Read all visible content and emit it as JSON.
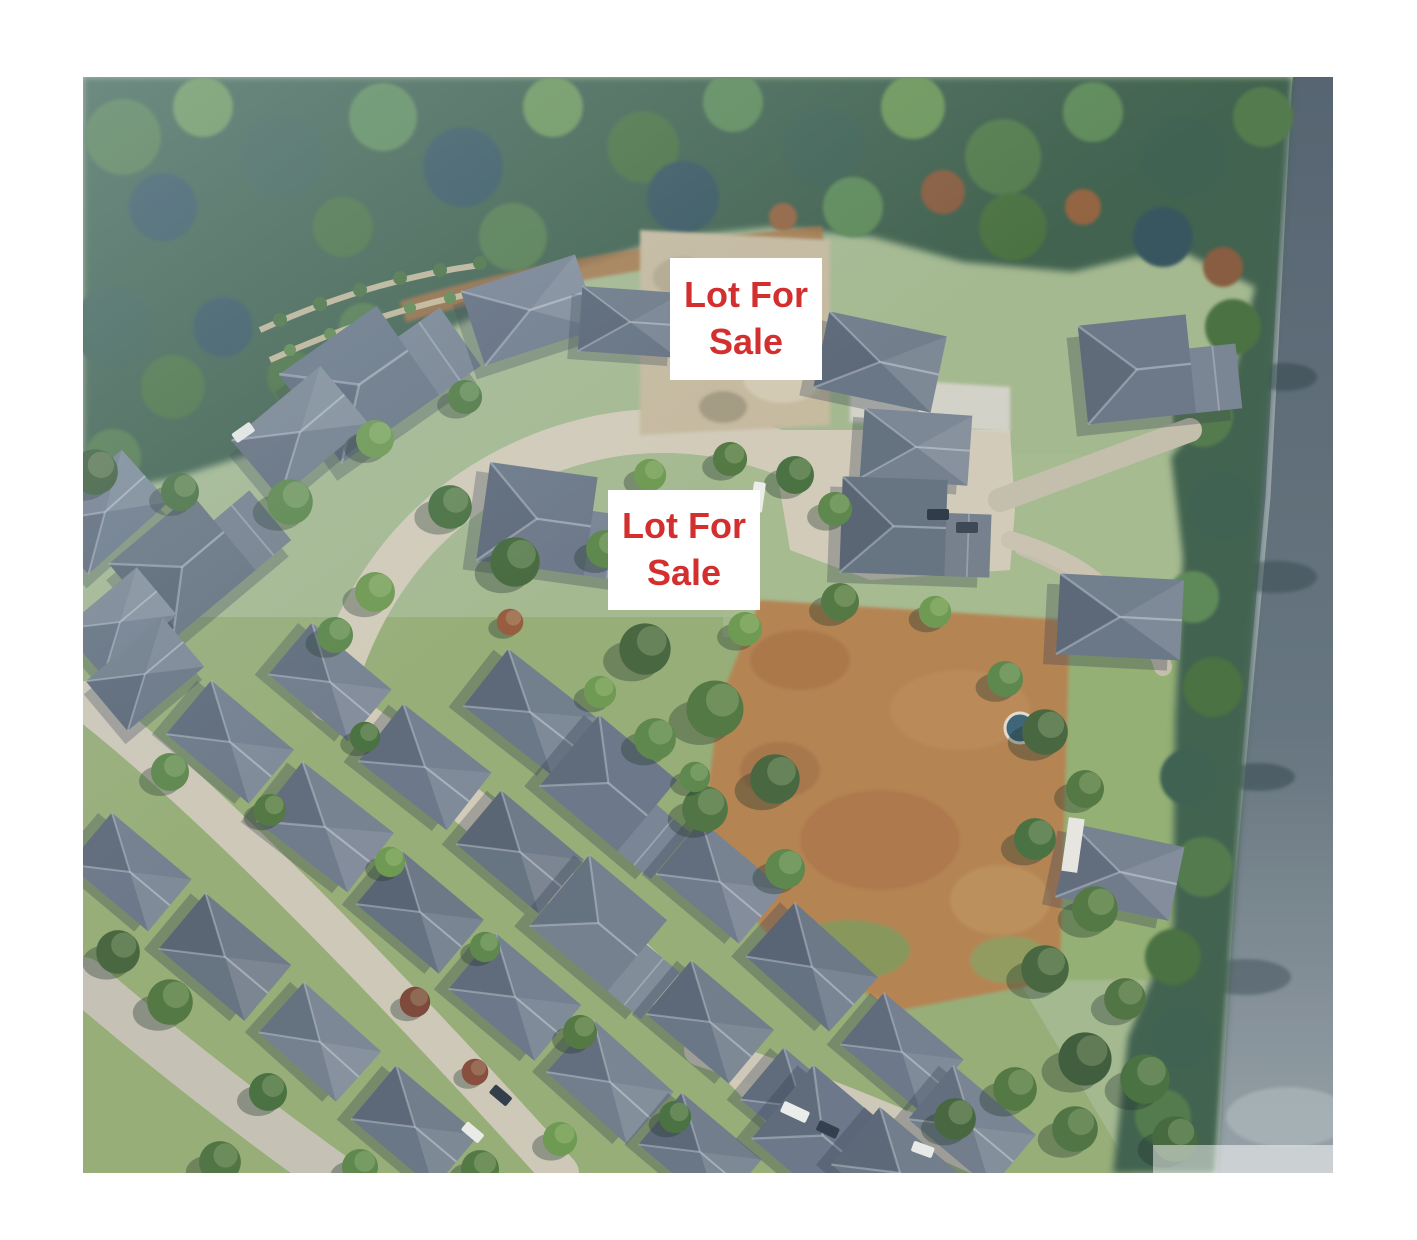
{
  "scene": {
    "kind": "aerial-photograph",
    "description": "Aerial view of a suburban cul-de-sac neighbourhood bordered by forest at the top, a main road along the right edge, a dry brown field, and rows of grey-roofed houses, with two vacant lots marked for sale"
  },
  "colors": {
    "accent": "#d32f2f",
    "label_background": "#ffffff",
    "page_background": "#ffffff"
  },
  "labels": [
    {
      "id": "lot-for-sale-1",
      "line1": "Lot For",
      "line2": "Sale"
    },
    {
      "id": "lot-for-sale-2",
      "line1": "Lot For",
      "line2": "Sale"
    }
  ]
}
